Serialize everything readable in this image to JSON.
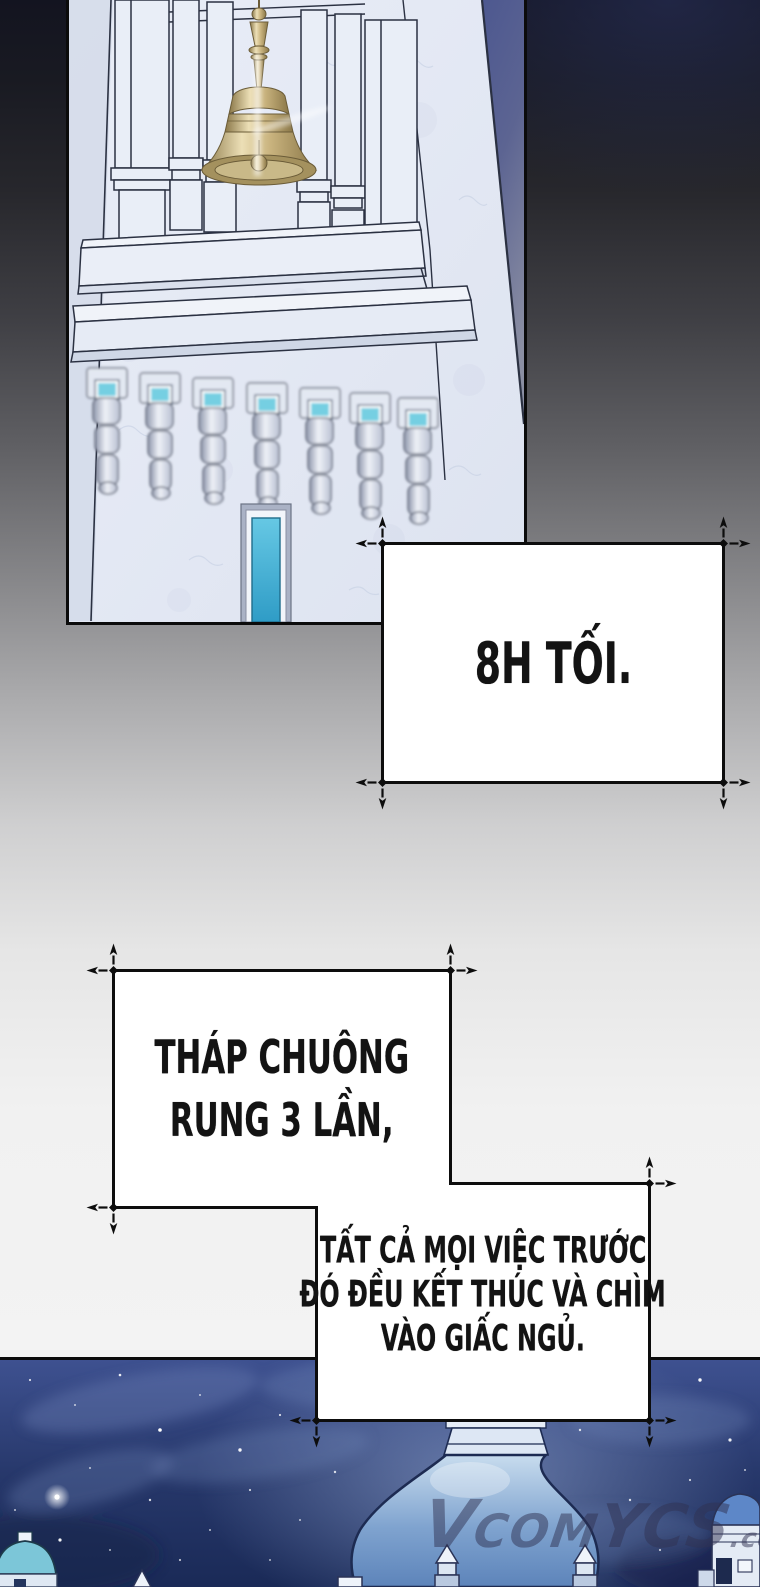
{
  "page": {
    "width": 760,
    "height": 1587,
    "kind": "webtoon comic page (Vietnamese)"
  },
  "colors": {
    "page_top": "#131420",
    "page_light": "#f5f5f5",
    "panel_border": "#0b0b0b",
    "marble": "#e3e8f3",
    "marble_vein": "#c5cfe2",
    "line_ink": "#2b3142",
    "sky_wedge": "#4d5890",
    "gold": "#c9b37e",
    "gold_dark": "#8a7748",
    "gem": "#74cfe2",
    "glass": "#54bcdd",
    "night_top": "#3e5190",
    "night_mid": "#27386b",
    "night_deep": "#1a2a57",
    "cloud": "#7388bb",
    "dome_light": "#c8dcee",
    "dome_mid": "#7fa3cf",
    "dome_deep": "#5d84ba",
    "dome_ink": "#1d2b52",
    "white_struct": "#e6edf7",
    "teal_dome": "#7cc6d8",
    "watermark": "rgba(47,50,82,0.5)",
    "caption_bg": "#ffffff",
    "caption_ink": "#131313"
  },
  "panels": {
    "bell_tower": {
      "alt": "Tilted marble bell tower with a golden bell, twin columns, corbel brackets with cyan gems and a tall cyan window"
    },
    "night_scene": {
      "alt": "Palace domes and turrets under a starry night sky"
    }
  },
  "captions": {
    "c1": {
      "text": "8H TỐI."
    },
    "c2": {
      "line1": "THÁP CHUÔNG",
      "line2": "RUNG 3 LẦN,"
    },
    "c3": {
      "line1": "TẤT CẢ MỌI VIỆC TRƯỚC",
      "line2": "ĐÓ ĐỀU KẾT THÚC VÀ CHÌM",
      "line3": "VÀO GIẤC NGỦ."
    }
  },
  "watermark": {
    "v": "V",
    "com": "COM",
    "ycs": "YCS",
    "suffix": ".co"
  },
  "icons": {
    "crosshair_mark": "registration crosshair with outward arrows at caption box corners"
  }
}
